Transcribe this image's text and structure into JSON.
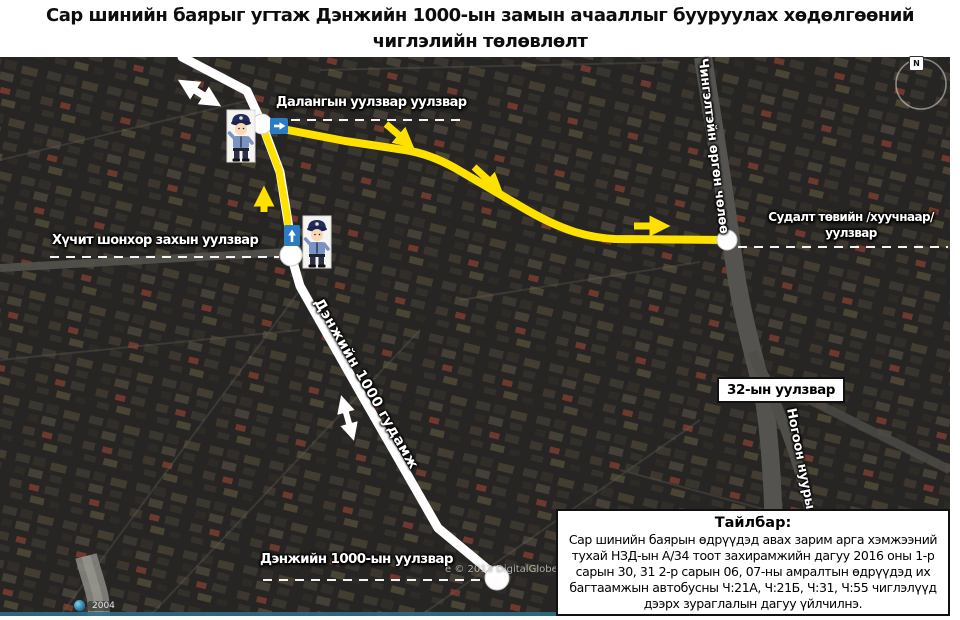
{
  "title": {
    "line1": "Сар шинийн баярыг угтаж Дэнжийн 1000-ын замын ачааллыг бууруулах хөдөлгөөний",
    "line2": "чиглэлийн төлөвлөлт"
  },
  "map": {
    "labels": {
      "dalangiin": "Далангын уулзвар уулзвар",
      "khuchit": "Хүчит шонхор захын уулзвар",
      "sudalt_line1": "Судалт төвийн /хуучнаар/",
      "sudalt_line2": "уулзвар",
      "junction32": "32-ын уулзвар",
      "denjiin_junction": "Дэнжийн 1000-ын уулзвар"
    },
    "road_labels": {
      "denjiin_street": "Дэнжийн 1000 гудамж",
      "chingeltei": "Чингэлтэйн өргөн чөлөө",
      "nogoon_nuuryn": "Ногоон нуурын"
    },
    "compass_n": "N",
    "credits": {
      "digitalglobe": "е © 2013 DigitalGlobe",
      "year2004": "2004"
    },
    "colors": {
      "route_yellow": "#FFE100",
      "road_white": "#ffffff",
      "sign_blue": "#2B7BC5"
    }
  },
  "legend": {
    "title": "Тайлбар:",
    "body": "Сар шинийн баярын өдрүүдэд авах зарим арга хэмжээний тухай НЗД-ын А/34 тоот захирамжийн дагуу 2016 оны 1-р сарын 30, 31 2-р сарын 06, 07-ны амралтын өдрүүдэд их багтаамжын автобусны Ч:21А, Ч:21Б, Ч:31, Ч:55 чиглэлүүд дээрх зураглалын дагуу үйлчилнэ."
  }
}
